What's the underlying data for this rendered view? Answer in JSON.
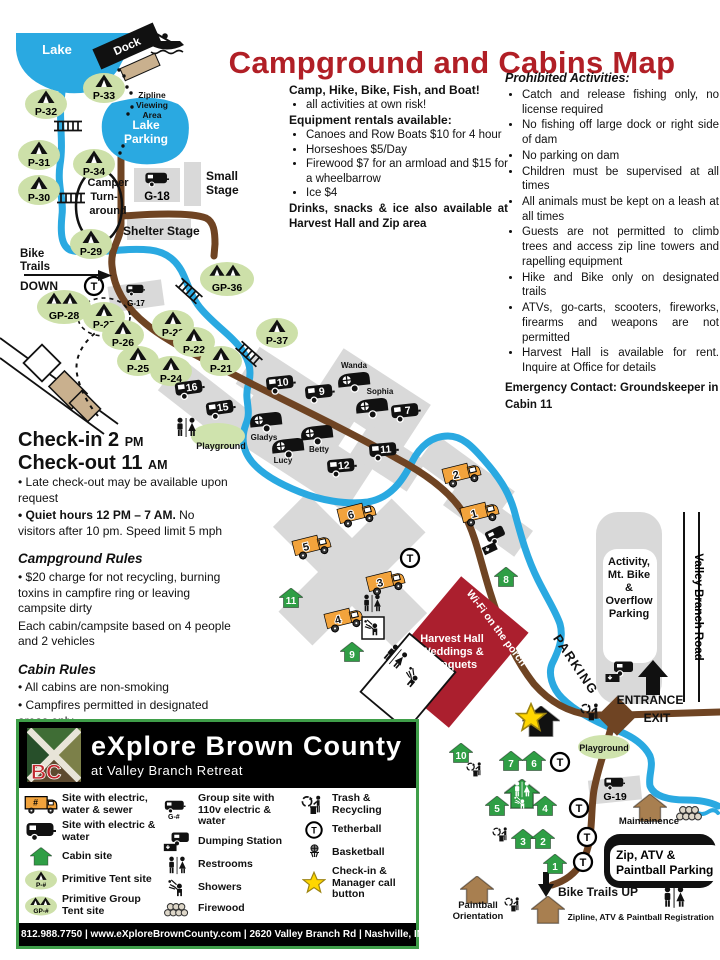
{
  "title": "Campground and Cabins Map",
  "colors": {
    "title_red": "#b11f26",
    "water_blue": "#2aa9e1",
    "road_brown": "#6f4423",
    "cabin_green": "#2f9e45",
    "site_oval_green": "#cde0a9",
    "rv_orange": "#f2a33c",
    "harvest_red": "#ab1f2e",
    "legend_border_green": "#3f9e49",
    "star_yellow": "#ffd700"
  },
  "info": {
    "heading": "Camp, Hike, Bike, Fish, and Boat!",
    "bullet0": "all activities at own risk!",
    "rentals_heading": "Equipment rentals available:",
    "rentals": [
      "Canoes and Row Boats $10 for 4 hour",
      "Horseshoes $5/Day",
      "Firewood $7 for an armload and $15 for a wheelbarrow",
      "Ice $4"
    ],
    "drinks": "Drinks, snacks & ice also available at Harvest Hall and Zip area"
  },
  "prohibited": {
    "heading": "Prohibited Activities:",
    "items": [
      "Catch and release fishing only, no license required",
      "No fishing off large dock or right side of dam",
      "No parking on dam",
      "Children must be supervised at all times",
      "All animals must be kept on a leash at all times",
      "Guests are not permitted to climb trees and access zip line towers and rapelling equipment",
      "Hike and Bike only on designated trails",
      "ATVs, go-carts, scooters, fireworks, firearms and weapons are not permitted",
      "Harvest Hall is available for rent.  Inquire at Office for details"
    ],
    "emergency": "Emergency Contact: Groundskeeper in Cabin 11"
  },
  "rules": {
    "checkin": "Check-in 2",
    "checkin_ampm": "PM",
    "checkout": "Check-out 11",
    "checkout_ampm": "AM",
    "late": "• Late check-out may be available upon request",
    "quiet_bold": "• Quiet hours 12 PM – 7 AM.",
    "quiet_rest": " No visitors after 10 pm. Speed limit 5 mph",
    "campground_heading": "Campground Rules",
    "campground_item0": "• $20 charge for not recycling, burning toxins in campfire ring or leaving campsite dirty",
    "campground_item1": "Each cabin/campsite based on 4 people and 2 vehicles",
    "cabin_heading": "Cabin Rules",
    "cabin_items": [
      "• All cabins are non-smoking",
      "• Campfires permitted in designated areas only",
      "• $20 lost key fee"
    ]
  },
  "legend": {
    "brand": "eXplore Brown County",
    "brand_sub": "at Valley Branch Retreat",
    "logo_bc": "BC",
    "sym": {
      "num": "#",
      "p": "P-#",
      "gp": "GP-#",
      "g": "G-#"
    },
    "col1": [
      "Site with electric, water & sewer",
      "Site with electric & water",
      "Cabin site",
      "Primitive Tent site",
      "Primitive Group Tent site"
    ],
    "col2": [
      "Group site with 110v electric & water",
      "Dumping Station",
      "Restrooms",
      "Showers",
      "Firewood"
    ],
    "col3": [
      "Trash & Recycling",
      "Tetherball",
      "Basketball",
      "Check-in & Manager call button"
    ],
    "footer": "812.988.7750 | www.eXploreBrownCounty.com | 2620 Valley Branch Rd | Nashville, IN 47448"
  },
  "map": {
    "lake": "Lake",
    "dock": "Dock",
    "zipline_viewing": [
      "Zipline",
      "Viewing",
      "Area"
    ],
    "lake_parking": [
      "Lake",
      "Parking"
    ],
    "turnaround": [
      "Camper",
      "Turn-",
      "around"
    ],
    "small_stage": [
      "Small",
      "Stage"
    ],
    "shelter_stage": "Shelter Stage",
    "bike_down": [
      "Bike",
      "Trails",
      "DOWN"
    ],
    "bike_up": "Bike Trails UP",
    "playground": "Playground",
    "parking": "PARKING",
    "wifi": "Wi-Fi on the porch",
    "harvest": [
      "Harvest Hall",
      "Weddings &",
      "Banquets"
    ],
    "activity": [
      "Activity,",
      "Mt. Bike",
      "&",
      "Overflow",
      "Parking"
    ],
    "road": "Valley Branch Road",
    "entrance": "ENTRANCE",
    "exit": "EXIT",
    "zip_atv": [
      "Zip, ATV &",
      "Paintball Parking"
    ],
    "maint": "Maintainence",
    "pb_orient": [
      "Paintball",
      "Orientation"
    ],
    "registration": "Zipline, ATV & Paintball Registration",
    "t": "T",
    "tents": [
      "P-33",
      "P-32",
      "P-31",
      "P-34",
      "P-30",
      "P-29",
      "P-27",
      "P-26",
      "P-23",
      "P-22",
      "P-25",
      "P-24",
      "P-21",
      "P-37"
    ],
    "gtents": [
      "GP-28",
      "GP-36"
    ],
    "gsites": [
      "G-18",
      "G-17",
      "G-19"
    ],
    "trailers": [
      "16",
      "15",
      "10",
      "9",
      "7",
      "11",
      "12"
    ],
    "trailer_names": [
      "Wanda",
      "Sophia",
      "Gladys",
      "Lucy",
      "Betty"
    ],
    "rvs": [
      "2",
      "1",
      "6",
      "5",
      "3",
      "4"
    ],
    "cabins": [
      "8",
      "11",
      "9",
      "10",
      "7",
      "6",
      "5",
      "4",
      "3",
      "2",
      "1"
    ]
  }
}
